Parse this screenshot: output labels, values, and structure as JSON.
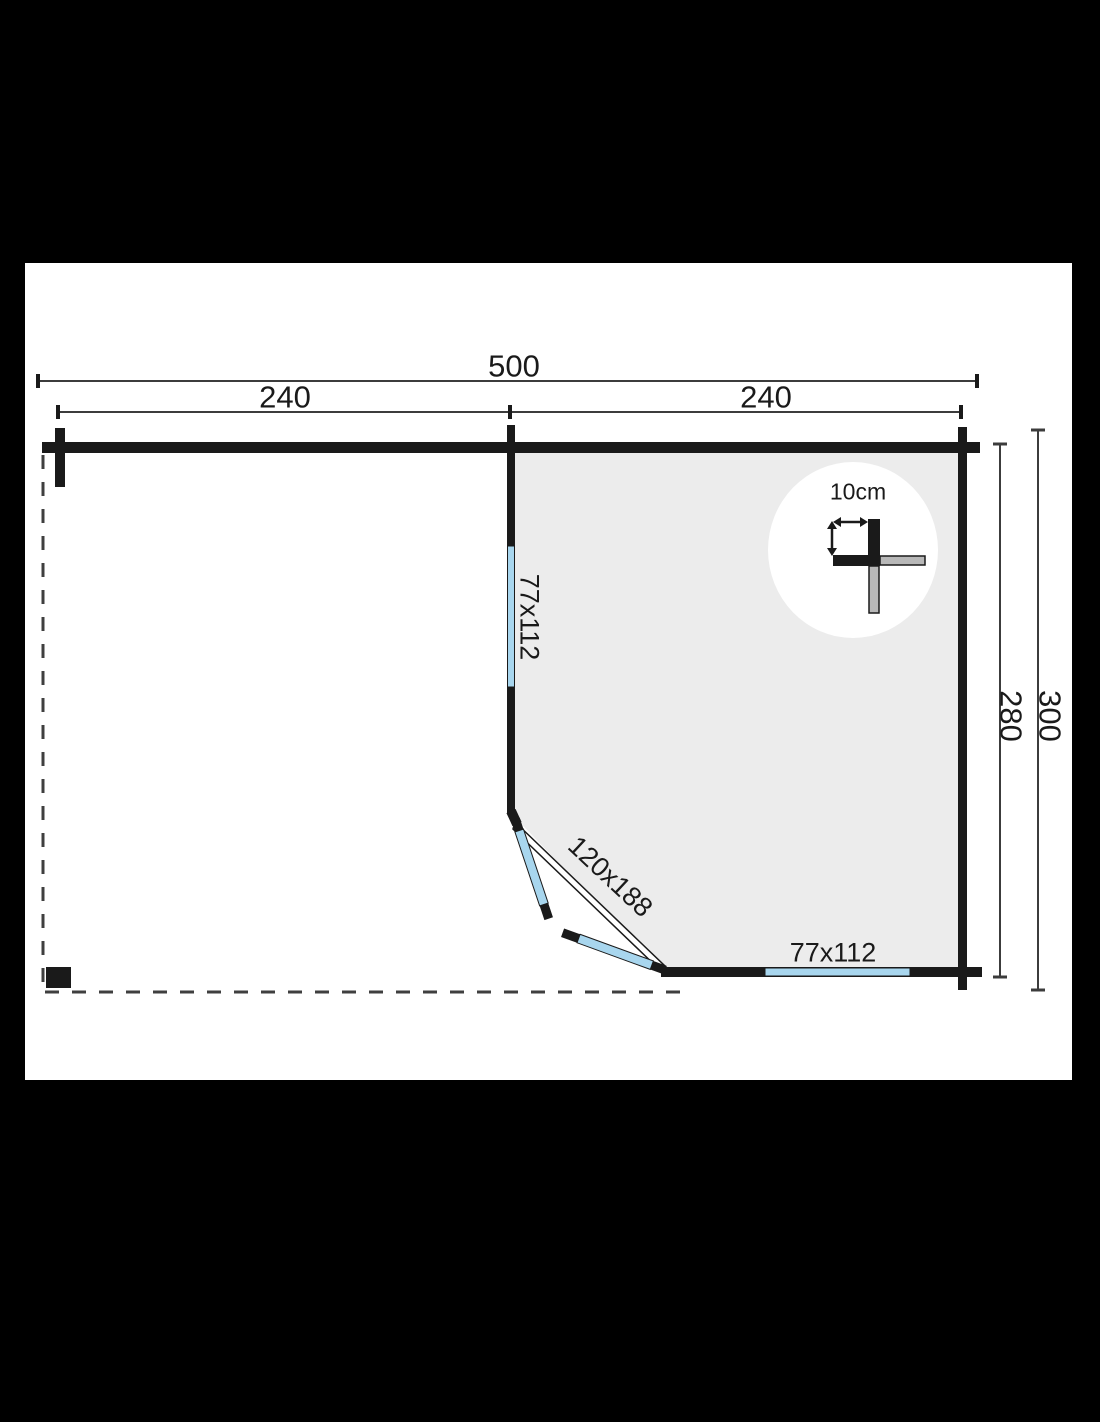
{
  "drawing": {
    "dim_total_width": "500",
    "dim_left_span": "240",
    "dim_right_span": "240",
    "dim_inner_depth": "280",
    "dim_total_depth": "300",
    "label_side_window": "77x112",
    "label_door": "120x188",
    "label_front_window": "77x112",
    "label_wall_thickness": "10cm"
  },
  "colors": {
    "background": "#000000",
    "paper": "#ffffff",
    "wall": "#1a1a1a",
    "interior": "#ececec",
    "glass": "#a8d6ee",
    "dim-line": "#3c3c3c",
    "detail-gray": "#b8b8b8"
  }
}
